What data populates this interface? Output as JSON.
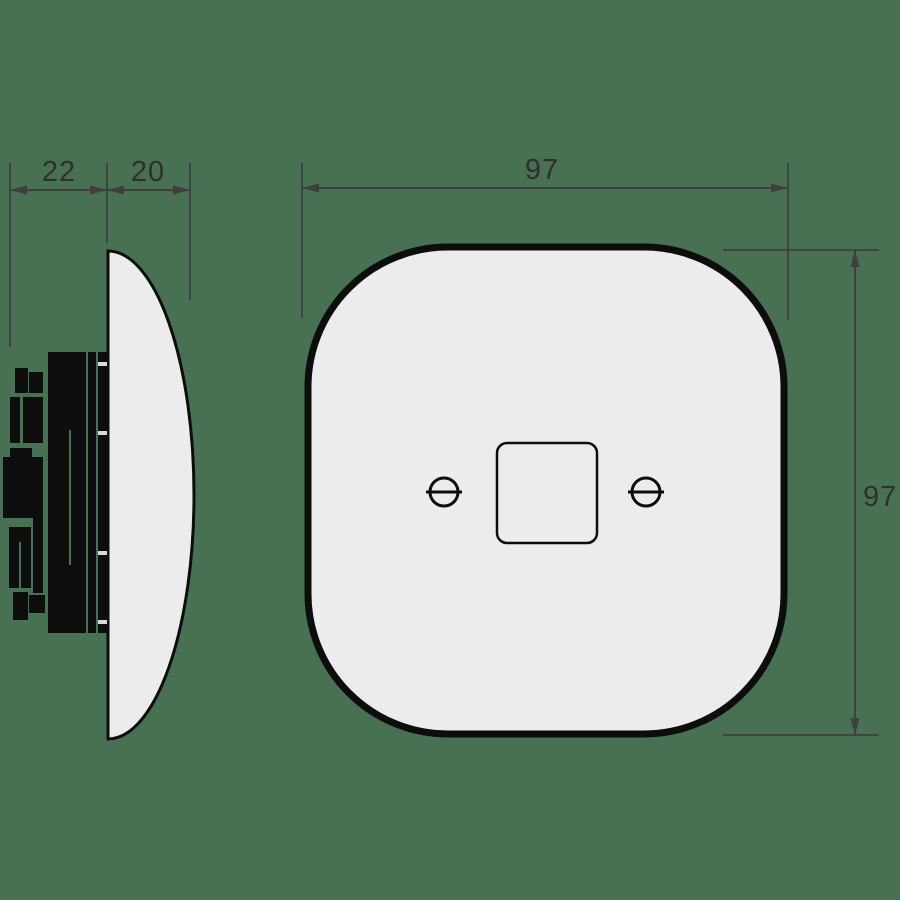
{
  "drawing": {
    "dimensions": {
      "rear_depth": "22",
      "cover_depth": "20",
      "plate_width": "97",
      "plate_height": "97"
    },
    "colors": {
      "background": "#487052",
      "plate_fill": "#ececec",
      "outline": "#0d0d0d",
      "silhouette": "#0d0d0d",
      "dimension_line": "#3f3f3f",
      "dimension_text": "#2f2f2f"
    }
  }
}
